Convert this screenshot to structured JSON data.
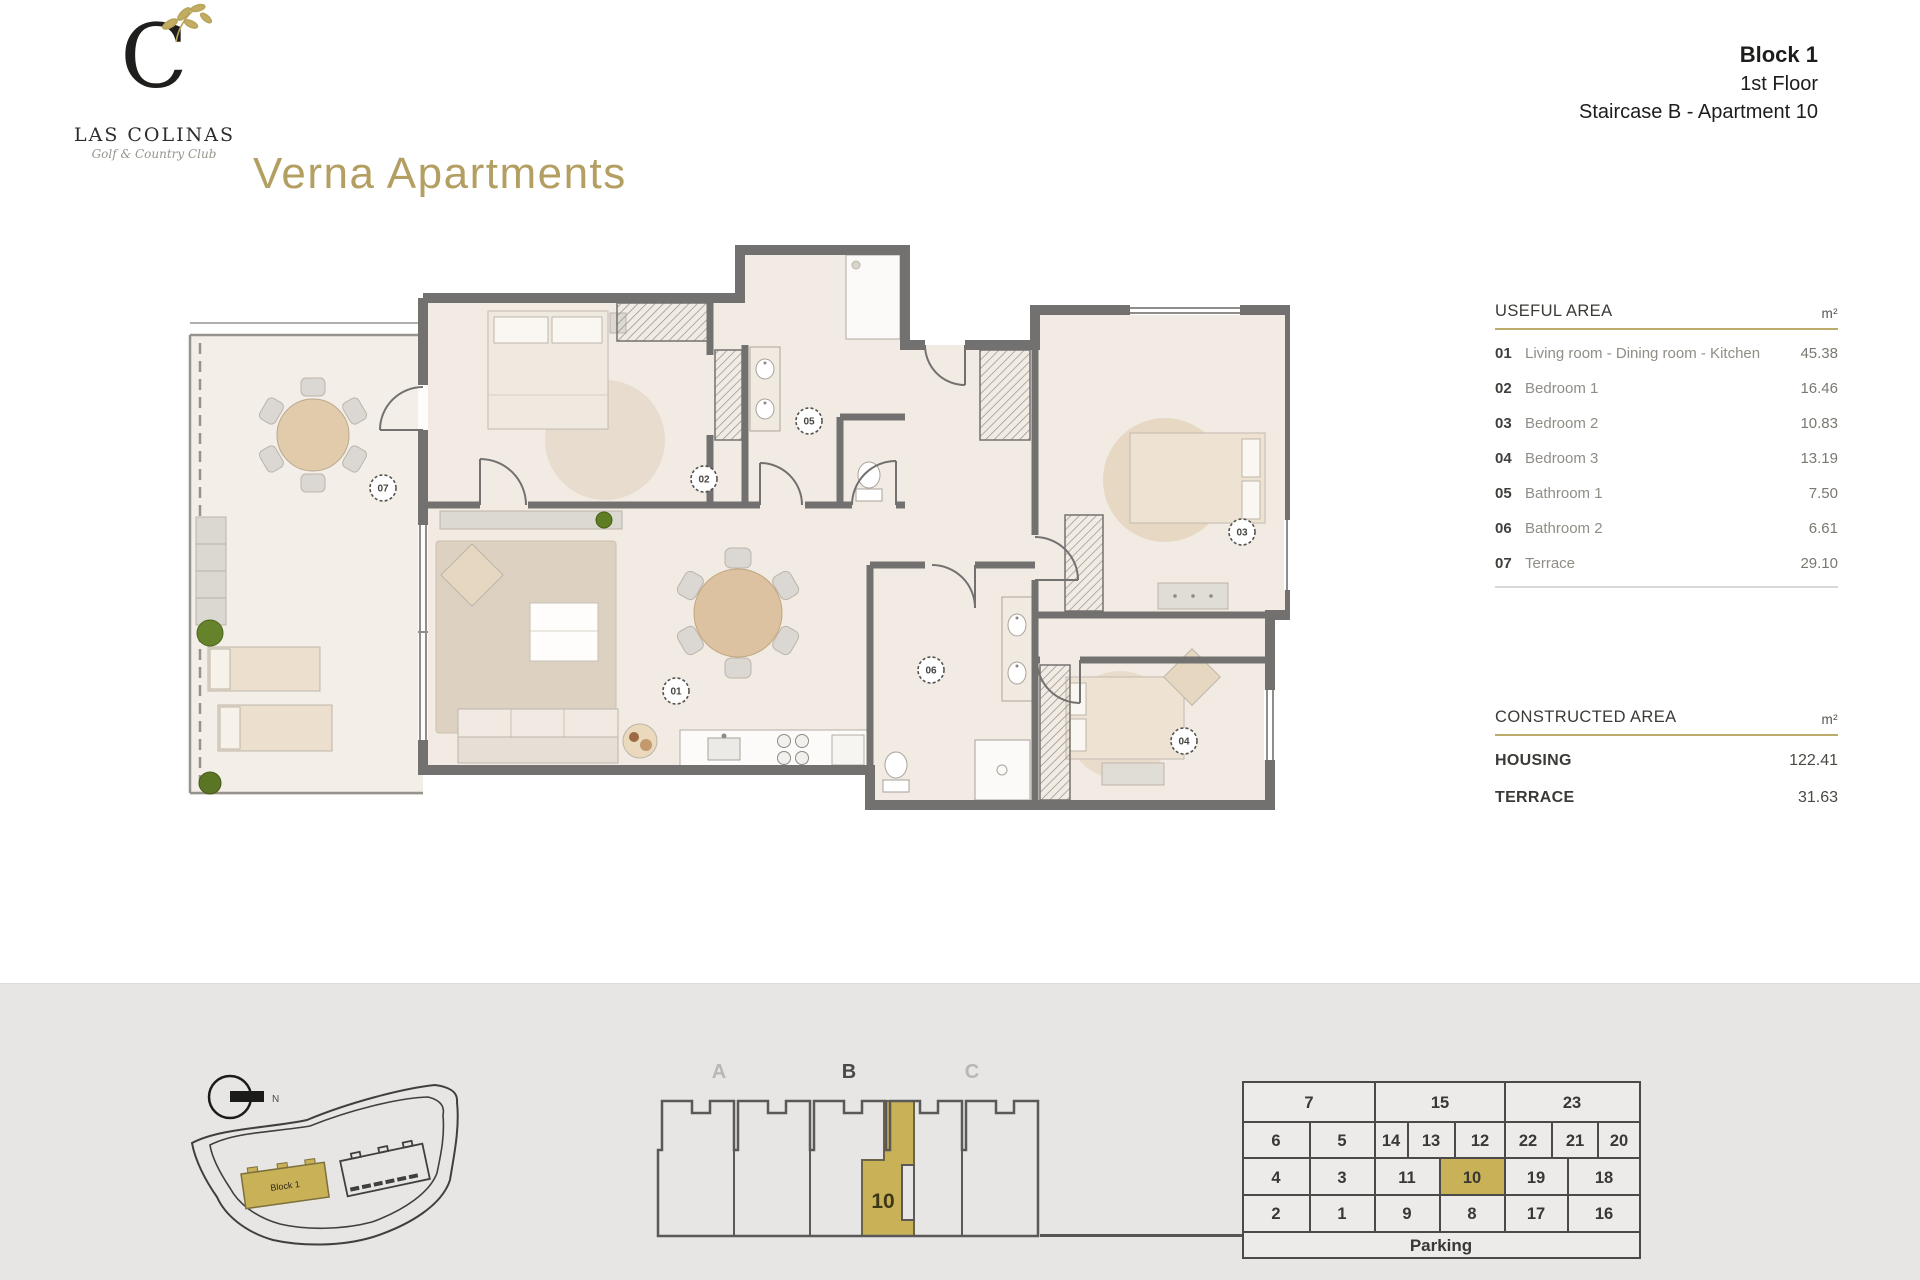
{
  "header": {
    "monogram": "C",
    "brand": "LAS COLINAS",
    "brand_sub": "Golf & Country Club",
    "title": "Verna Apartments",
    "block": "Block 1",
    "floor": "1st Floor",
    "staircase": "Staircase B - Apartment 10"
  },
  "useful_area": {
    "title": "USEFUL AREA",
    "unit": "m²",
    "rows": [
      {
        "num": "01",
        "label": "Living room - Dining room - Kitchen",
        "value": "45.38"
      },
      {
        "num": "02",
        "label": "Bedroom 1",
        "value": "16.46"
      },
      {
        "num": "03",
        "label": "Bedroom 2",
        "value": "10.83"
      },
      {
        "num": "04",
        "label": "Bedroom 3",
        "value": "13.19"
      },
      {
        "num": "05",
        "label": "Bathroom 1",
        "value": "7.50"
      },
      {
        "num": "06",
        "label": "Bathroom 2",
        "value": "6.61"
      },
      {
        "num": "07",
        "label": "Terrace",
        "value": "29.10"
      }
    ]
  },
  "constructed_area": {
    "title": "CONSTRUCTED AREA",
    "unit": "m²",
    "rows": [
      {
        "label": "HOUSING",
        "value": "122.41"
      },
      {
        "label": "TERRACE",
        "value": "31.63"
      }
    ]
  },
  "plan": {
    "room_labels": {
      "r01": "01",
      "r02": "02",
      "r03": "03",
      "r04": "04",
      "r05": "05",
      "r06": "06",
      "r07": "07"
    }
  },
  "site_plan": {
    "north_label": "N",
    "block_label": "Block 1"
  },
  "elevation": {
    "staircase_a": "A",
    "staircase_b": "B",
    "staircase_c": "C",
    "unit": "10"
  },
  "parking": {
    "row1": [
      "7",
      "15",
      "23"
    ],
    "row2": [
      "6",
      "5",
      "14",
      "13",
      "12",
      "22",
      "21",
      "20"
    ],
    "row3": [
      "4",
      "3",
      "11",
      "10",
      "19",
      "18"
    ],
    "row4": [
      "2",
      "1",
      "9",
      "8",
      "17",
      "16"
    ],
    "label": "Parking"
  },
  "colors": {
    "accent_gold": "#b49f62",
    "highlight_gold": "#c9b158",
    "wall_gray": "#737170"
  }
}
